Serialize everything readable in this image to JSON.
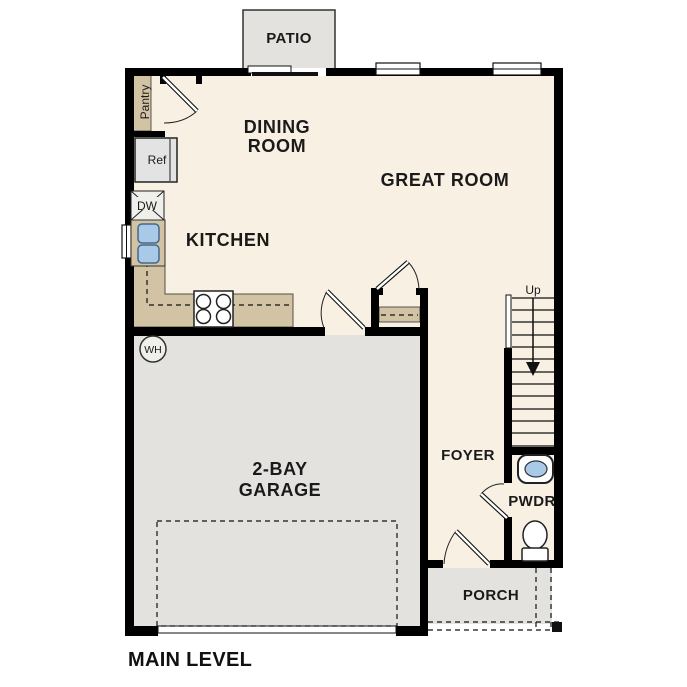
{
  "title": "MAIN LEVEL",
  "colors": {
    "floor": "#F8F0E3",
    "tan": "#D2C3A4",
    "gray": "#E3E2DF",
    "gray_light": "#EFEFEC",
    "appliance_gray": "#E3E3E3",
    "blue": "#A9C9E9",
    "wall": "#000000"
  },
  "rooms": {
    "patio": "PATIO",
    "dining_line1": "DINING",
    "dining_line2": "ROOM",
    "great": "GREAT ROOM",
    "kitchen": "KITCHEN",
    "garage_line1": "2-BAY",
    "garage_line2": "GARAGE",
    "foyer": "FOYER",
    "powder": "PWDR",
    "porch": "PORCH"
  },
  "fixtures": {
    "pantry": "Pantry",
    "refrigerator": "Ref",
    "dishwasher": "DW",
    "water_heater": "WH",
    "stairs_direction": "Up"
  }
}
